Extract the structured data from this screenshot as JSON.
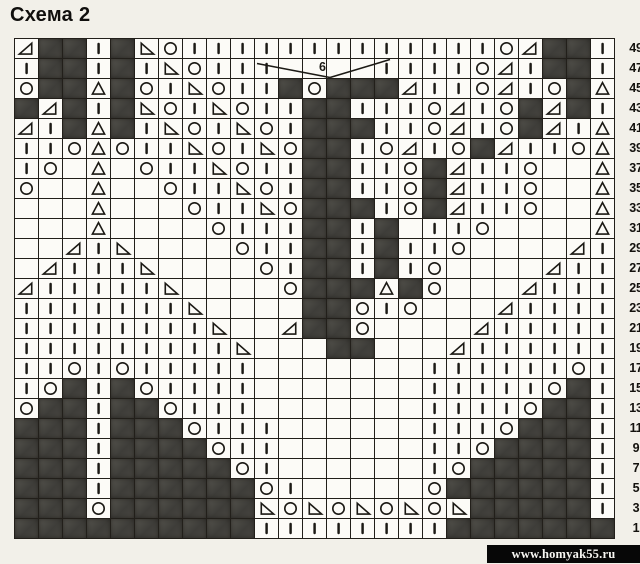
{
  "page": {
    "title": "Схема 2",
    "watermark": "www.homyak55.ru"
  },
  "annotation": {
    "label": "6",
    "meaning": "bracket marking 6 stitches over the shaded block",
    "over_row": 47,
    "span_columns": [
      11,
      16
    ]
  },
  "colors": {
    "paper": "#f2f0e9",
    "cell_background": "#fcfbf7",
    "grid_line": "#221f1a",
    "symbol_ink": "#1c1a15",
    "shaded_cell": "#46443f",
    "watermark_bg": "#070707",
    "watermark_text": "#f7f6f2"
  },
  "chart_data": {
    "type": "knitting-chart-grid",
    "columns": 25,
    "row_numbers_side": "right",
    "symbol_codes": {
      "k": "knit-stitch-vertical-bar",
      "o": "yarn-over-circle",
      "lt": "left-leaning-decrease-triangle",
      "rt": "right-leaning-decrease-triangle",
      "ct": "centered-double-decrease-triangle",
      "x": "shaded-no-stitch-cell",
      "": "empty-cell"
    },
    "rows": [
      {
        "number": 49,
        "cells": [
          "rt",
          "x",
          "x",
          "k",
          "x",
          "lt",
          "o",
          "k",
          "k",
          "k",
          "k",
          "k",
          "k",
          "k",
          "k",
          "k",
          "k",
          "k",
          "k",
          "k",
          "o",
          "rt",
          "x",
          "x",
          "k"
        ]
      },
      {
        "number": 47,
        "cells": [
          "k",
          "x",
          "x",
          "k",
          "x",
          "k",
          "lt",
          "o",
          "k",
          "k",
          "k",
          "",
          "",
          "",
          "",
          "k",
          "k",
          "k",
          "k",
          "o",
          "rt",
          "k",
          "x",
          "x",
          "k"
        ]
      },
      {
        "number": 45,
        "cells": [
          "o",
          "x",
          "x",
          "ct",
          "x",
          "o",
          "k",
          "lt",
          "o",
          "k",
          "k",
          "x",
          "o",
          "x",
          "x",
          "x",
          "rt",
          "k",
          "k",
          "o",
          "rt",
          "k",
          "o",
          "x",
          "ct"
        ]
      },
      {
        "number": 43,
        "cells": [
          "x",
          "rt",
          "x",
          "k",
          "x",
          "lt",
          "o",
          "k",
          "lt",
          "o",
          "k",
          "k",
          "x",
          "x",
          "k",
          "k",
          "k",
          "o",
          "rt",
          "k",
          "o",
          "x",
          "rt",
          "x",
          "k"
        ]
      },
      {
        "number": 41,
        "cells": [
          "rt",
          "k",
          "x",
          "ct",
          "x",
          "k",
          "lt",
          "o",
          "k",
          "lt",
          "o",
          "k",
          "x",
          "x",
          "x",
          "k",
          "k",
          "o",
          "rt",
          "k",
          "o",
          "x",
          "rt",
          "k",
          "ct"
        ]
      },
      {
        "number": 39,
        "cells": [
          "k",
          "k",
          "o",
          "ct",
          "o",
          "k",
          "k",
          "lt",
          "o",
          "k",
          "lt",
          "o",
          "x",
          "x",
          "k",
          "o",
          "rt",
          "k",
          "o",
          "x",
          "rt",
          "k",
          "k",
          "o",
          "ct"
        ]
      },
      {
        "number": 37,
        "cells": [
          "k",
          "o",
          "",
          "ct",
          "",
          "o",
          "k",
          "k",
          "lt",
          "o",
          "k",
          "k",
          "x",
          "x",
          "k",
          "k",
          "o",
          "x",
          "rt",
          "k",
          "k",
          "o",
          "",
          "",
          "ct"
        ]
      },
      {
        "number": 35,
        "cells": [
          "o",
          "",
          "",
          "ct",
          "",
          "",
          "o",
          "k",
          "k",
          "lt",
          "o",
          "k",
          "x",
          "x",
          "k",
          "k",
          "o",
          "x",
          "rt",
          "k",
          "k",
          "o",
          "",
          "",
          "ct"
        ]
      },
      {
        "number": 33,
        "cells": [
          "",
          "",
          "",
          "ct",
          "",
          "",
          "",
          "o",
          "k",
          "k",
          "lt",
          "o",
          "x",
          "x",
          "x",
          "k",
          "o",
          "x",
          "rt",
          "k",
          "k",
          "o",
          "",
          "",
          "ct"
        ]
      },
      {
        "number": 31,
        "cells": [
          "",
          "",
          "",
          "ct",
          "",
          "",
          "",
          "",
          "o",
          "k",
          "k",
          "k",
          "x",
          "x",
          "k",
          "x",
          "",
          "k",
          "k",
          "o",
          "",
          "",
          "",
          "",
          "ct"
        ]
      },
      {
        "number": 29,
        "cells": [
          "",
          "",
          "rt",
          "k",
          "lt",
          "",
          "",
          "",
          "",
          "o",
          "k",
          "k",
          "x",
          "x",
          "k",
          "x",
          "k",
          "k",
          "o",
          "",
          "",
          "",
          "",
          "rt",
          "k"
        ]
      },
      {
        "number": 27,
        "cells": [
          "",
          "rt",
          "k",
          "k",
          "k",
          "lt",
          "",
          "",
          "",
          "",
          "o",
          "k",
          "x",
          "x",
          "k",
          "x",
          "k",
          "o",
          "",
          "",
          "",
          "",
          "rt",
          "k",
          "k"
        ]
      },
      {
        "number": 25,
        "cells": [
          "rt",
          "k",
          "k",
          "k",
          "k",
          "k",
          "lt",
          "",
          "",
          "",
          "",
          "o",
          "x",
          "x",
          "x",
          "ct",
          "x",
          "o",
          "",
          "",
          "",
          "rt",
          "k",
          "k",
          "k"
        ]
      },
      {
        "number": 23,
        "cells": [
          "k",
          "k",
          "k",
          "k",
          "k",
          "k",
          "k",
          "lt",
          "",
          "",
          "",
          "",
          "x",
          "x",
          "o",
          "k",
          "o",
          "",
          "",
          "",
          "rt",
          "k",
          "k",
          "k",
          "k"
        ]
      },
      {
        "number": 21,
        "cells": [
          "k",
          "k",
          "k",
          "k",
          "k",
          "k",
          "k",
          "k",
          "lt",
          "",
          "",
          "rt",
          "x",
          "x",
          "o",
          "",
          "",
          "",
          "",
          "rt",
          "k",
          "k",
          "k",
          "k",
          "k"
        ]
      },
      {
        "number": 19,
        "cells": [
          "k",
          "k",
          "k",
          "k",
          "k",
          "k",
          "k",
          "k",
          "k",
          "lt",
          "",
          "",
          "",
          "x",
          "x",
          "",
          "",
          "",
          "rt",
          "k",
          "k",
          "k",
          "k",
          "k",
          "k"
        ]
      },
      {
        "number": 17,
        "cells": [
          "k",
          "k",
          "o",
          "k",
          "o",
          "k",
          "k",
          "k",
          "k",
          "k",
          "",
          "",
          "",
          "",
          "",
          "",
          "",
          "k",
          "k",
          "k",
          "k",
          "k",
          "k",
          "o",
          "k"
        ]
      },
      {
        "number": 15,
        "cells": [
          "k",
          "o",
          "x",
          "k",
          "x",
          "o",
          "k",
          "k",
          "k",
          "k",
          "",
          "",
          "",
          "",
          "",
          "",
          "",
          "k",
          "k",
          "k",
          "k",
          "k",
          "o",
          "x",
          "k"
        ]
      },
      {
        "number": 13,
        "cells": [
          "o",
          "x",
          "x",
          "k",
          "x",
          "x",
          "o",
          "k",
          "k",
          "k",
          "",
          "",
          "",
          "",
          "",
          "",
          "",
          "k",
          "k",
          "k",
          "k",
          "o",
          "x",
          "x",
          "k"
        ]
      },
      {
        "number": 11,
        "cells": [
          "x",
          "x",
          "x",
          "k",
          "x",
          "x",
          "x",
          "o",
          "k",
          "k",
          "k",
          "",
          "",
          "",
          "",
          "",
          "",
          "k",
          "k",
          "k",
          "o",
          "x",
          "x",
          "x",
          "k"
        ]
      },
      {
        "number": 9,
        "cells": [
          "x",
          "x",
          "x",
          "k",
          "x",
          "x",
          "x",
          "x",
          "o",
          "k",
          "k",
          "",
          "",
          "",
          "",
          "",
          "",
          "k",
          "k",
          "o",
          "x",
          "x",
          "x",
          "x",
          "k"
        ]
      },
      {
        "number": 7,
        "cells": [
          "x",
          "x",
          "x",
          "k",
          "x",
          "x",
          "x",
          "x",
          "x",
          "o",
          "k",
          "",
          "",
          "",
          "",
          "",
          "",
          "k",
          "o",
          "x",
          "x",
          "x",
          "x",
          "x",
          "k"
        ]
      },
      {
        "number": 5,
        "cells": [
          "x",
          "x",
          "x",
          "k",
          "x",
          "x",
          "x",
          "x",
          "x",
          "x",
          "o",
          "k",
          "",
          "",
          "",
          "",
          "",
          "o",
          "x",
          "x",
          "x",
          "x",
          "x",
          "x",
          "k"
        ]
      },
      {
        "number": 3,
        "cells": [
          "x",
          "x",
          "x",
          "o",
          "x",
          "x",
          "x",
          "x",
          "x",
          "x",
          "lt",
          "o",
          "lt",
          "o",
          "lt",
          "o",
          "lt",
          "o",
          "lt",
          "x",
          "x",
          "x",
          "x",
          "x",
          "k"
        ]
      },
      {
        "number": 1,
        "cells": [
          "x",
          "x",
          "x",
          "x",
          "x",
          "x",
          "x",
          "x",
          "x",
          "x",
          "k",
          "k",
          "k",
          "k",
          "k",
          "k",
          "k",
          "k",
          "x",
          "x",
          "x",
          "x",
          "x",
          "x",
          "x"
        ]
      }
    ]
  }
}
